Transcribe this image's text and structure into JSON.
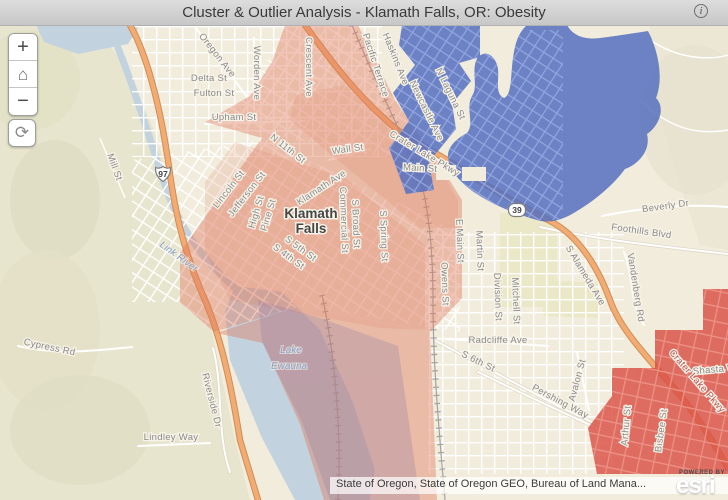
{
  "title_bar": {
    "title": "Cluster & Outlier Analysis - Klamath Falls, OR: Obesity",
    "info_glyph": "i"
  },
  "map_controls": {
    "zoom_in_label": "+",
    "zoom_out_label": "−",
    "home_icon": "⌂",
    "refresh_icon": "⟳"
  },
  "attribution": {
    "text": "State of Oregon, State of Oregon GEO, Bureau of Land Mana...",
    "powered_by": "POWERED BY",
    "logo": "esri"
  },
  "map": {
    "colors": {
      "high_high_fill": "#d94f44",
      "high_high_light_fill": "#e0795e",
      "low_low_fill": "#5570c0",
      "water_fill": "#c2d2de",
      "highway_fill": "#f2ab72"
    },
    "city_labels": [
      {
        "t": "Klamath",
        "x": 311,
        "y": 218,
        "r": 0
      },
      {
        "t": "Falls",
        "x": 311,
        "y": 233,
        "r": 0
      }
    ],
    "water_labels": [
      {
        "t": "Link River",
        "x": 177,
        "y": 259,
        "r": 36
      },
      {
        "t": "Lake",
        "x": 291,
        "y": 353,
        "r": 0
      },
      {
        "t": "Ewauna",
        "x": 289,
        "y": 369,
        "r": 0
      }
    ],
    "route_shields": [
      {
        "label": "97",
        "x": 163,
        "y": 174,
        "type": "us"
      },
      {
        "label": "39",
        "x": 517,
        "y": 210,
        "type": "state"
      }
    ],
    "street_labels": [
      {
        "t": "Oregon Ave",
        "x": 215,
        "y": 57,
        "r": 52
      },
      {
        "t": "Worden Ave",
        "x": 254,
        "y": 73,
        "r": 90
      },
      {
        "t": "Crescent Ave",
        "x": 306,
        "y": 67,
        "r": 90
      },
      {
        "t": "Delta St",
        "x": 209,
        "y": 81,
        "r": 0
      },
      {
        "t": "Fulton St",
        "x": 214,
        "y": 96,
        "r": 0
      },
      {
        "t": "Upham St",
        "x": 234,
        "y": 120,
        "r": 0
      },
      {
        "t": "N 11th St",
        "x": 286,
        "y": 151,
        "r": 38
      },
      {
        "t": "Wall St",
        "x": 348,
        "y": 152,
        "r": -8
      },
      {
        "t": "Main St",
        "x": 420,
        "y": 171,
        "r": 3
      },
      {
        "t": "Crater Lake Pkwy",
        "x": 423,
        "y": 156,
        "r": 31
      },
      {
        "t": "Lincoln St",
        "x": 231,
        "y": 191,
        "r": -52
      },
      {
        "t": "Jefferson St",
        "x": 249,
        "y": 196,
        "r": -52
      },
      {
        "t": "High St",
        "x": 259,
        "y": 213,
        "r": -73
      },
      {
        "t": "Pine St",
        "x": 271,
        "y": 216,
        "r": -73
      },
      {
        "t": "Klamath Ave",
        "x": 323,
        "y": 190,
        "r": -33
      },
      {
        "t": "Commercial St",
        "x": 341,
        "y": 220,
        "r": 88
      },
      {
        "t": "S Broad St",
        "x": 353,
        "y": 224,
        "r": 88
      },
      {
        "t": "S Spring St",
        "x": 381,
        "y": 236,
        "r": 88
      },
      {
        "t": "S 5th St",
        "x": 299,
        "y": 251,
        "r": 36
      },
      {
        "t": "S 4th St",
        "x": 287,
        "y": 259,
        "r": 36
      },
      {
        "t": "Mill St",
        "x": 112,
        "y": 168,
        "r": 70
      },
      {
        "t": "Haskins Ave",
        "x": 393,
        "y": 60,
        "r": 68
      },
      {
        "t": "Pacific Terrace",
        "x": 373,
        "y": 66,
        "r": 72
      },
      {
        "t": "Newcastle Ave",
        "x": 424,
        "y": 112,
        "r": 64
      },
      {
        "t": "N Laguna St",
        "x": 448,
        "y": 95,
        "r": 64
      },
      {
        "t": "E Main St",
        "x": 457,
        "y": 241,
        "r": 88
      },
      {
        "t": "Martin St",
        "x": 477,
        "y": 251,
        "r": 88
      },
      {
        "t": "Owens St",
        "x": 442,
        "y": 284,
        "r": 88
      },
      {
        "t": "Division St",
        "x": 495,
        "y": 297,
        "r": 88
      },
      {
        "t": "Mitchell St",
        "x": 513,
        "y": 301,
        "r": 88
      },
      {
        "t": "Radcliffe Ave",
        "x": 498,
        "y": 343,
        "r": 0
      },
      {
        "t": "S 6th St",
        "x": 477,
        "y": 364,
        "r": 26
      },
      {
        "t": "Pershing Way",
        "x": 559,
        "y": 404,
        "r": 28
      },
      {
        "t": "Avalon St",
        "x": 580,
        "y": 381,
        "r": -75
      },
      {
        "t": "S Alameda Ave",
        "x": 583,
        "y": 277,
        "r": 59
      },
      {
        "t": "Vandenberg Rd",
        "x": 633,
        "y": 288,
        "r": 81
      },
      {
        "t": "Foothills Blvd",
        "x": 641,
        "y": 234,
        "r": 8
      },
      {
        "t": "Beverly Dr",
        "x": 666,
        "y": 209,
        "r": -8
      },
      {
        "t": "Cypress Rd",
        "x": 49,
        "y": 350,
        "r": 12
      },
      {
        "t": "Riverside Dr",
        "x": 209,
        "y": 401,
        "r": 76
      },
      {
        "t": "Lindley Way",
        "x": 171,
        "y": 440,
        "r": 0
      },
      {
        "t": "Arthur St",
        "x": 629,
        "y": 426,
        "r": -85
      },
      {
        "t": "Bisbee St",
        "x": 664,
        "y": 431,
        "r": -82
      },
      {
        "t": "Shasta Way",
        "x": 720,
        "y": 372,
        "r": -5
      },
      {
        "t": "Crater Lake Pkwy",
        "x": 695,
        "y": 383,
        "r": 49,
        "cls": "hwy"
      }
    ]
  }
}
